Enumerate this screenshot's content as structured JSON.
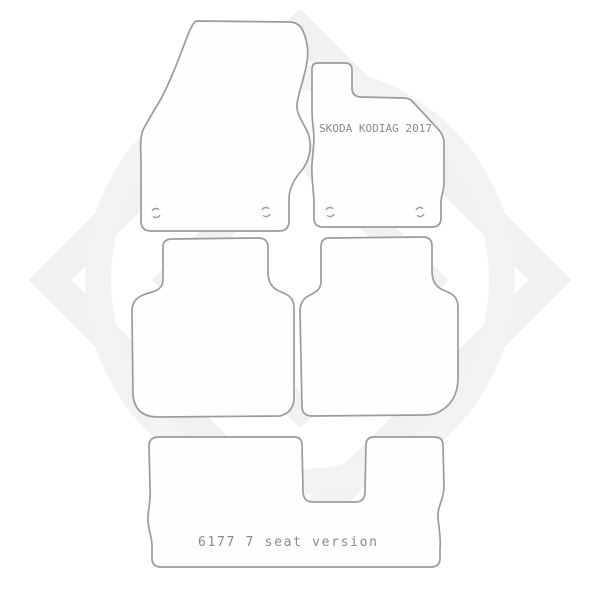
{
  "page": {
    "background": "#ffffff"
  },
  "style": {
    "outline_color": "#9b9b9b",
    "label_color": "#8a8a8a",
    "watermark_color": "#f1f1f1",
    "watermark_circle_color": "#f3f3f3"
  },
  "labels": {
    "passenger_mat_text": "SKODA KODIAG 2017",
    "boot_mat_text": "6177 7 seat version"
  }
}
